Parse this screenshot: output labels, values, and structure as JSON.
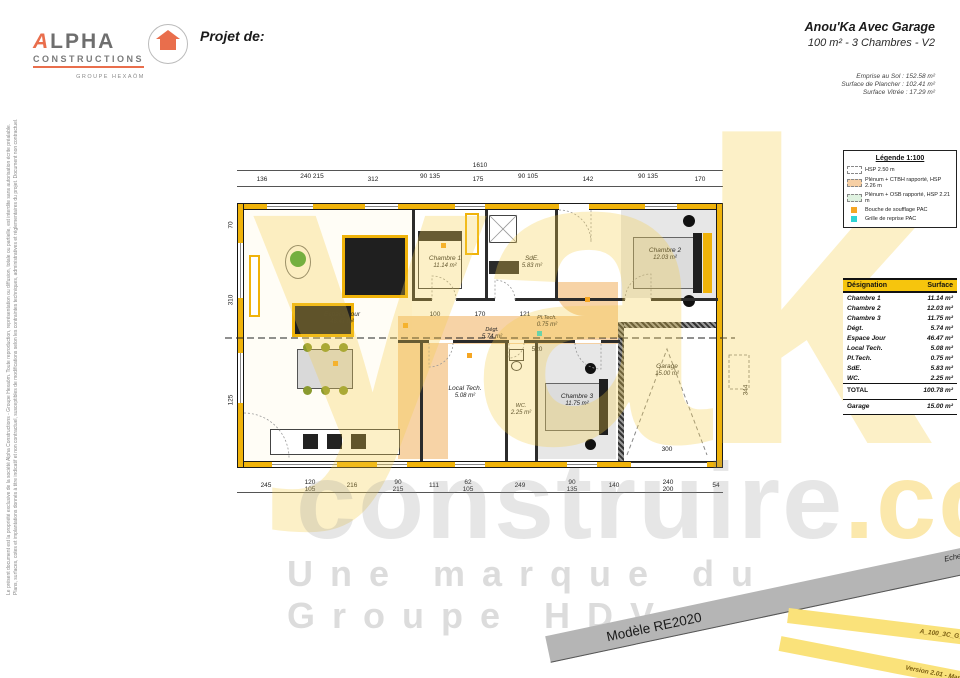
{
  "header": {
    "project_label": "Projet de:",
    "title": "Anou'Ka Avec Garage",
    "subtitle": "100 m² - 3 Chambres - V2",
    "surfaces": [
      "Emprise au Sol : 152.58 m²",
      "Surface de Plancher : 102.41 m²",
      "Surface Vitrée : 17.29 m²"
    ],
    "logo": {
      "name_a": "A",
      "name_rest": "LPHA",
      "subtitle": "CONSTRUCTIONS",
      "group": "GROUPE HEXAÖM"
    }
  },
  "disclaimer": {
    "line1": "Le présent document est la propriété exclusive de la société Alpha Constructions - Groupe Hexaöm. Toute reproduction, représentation ou diffusion, totale ou partielle, est interdite sans autorisation écrite préalable.",
    "line2": "Plans, surfaces, cotes et implantations donnés à titre indicatif et non contractuel, susceptibles de modifications selon les contraintes techniques, administratives et réglementaires du projet. Document non contractuel."
  },
  "watermark": {
    "big": "yak",
    "mid": "construire",
    "dotcom": ".com",
    "tagline": "Une marque du Groupe HDV"
  },
  "legend": {
    "title": "Légende 1:100",
    "items": [
      "HSP 2.50 m",
      "Plénum + CTBH rapporté, HSP 2.26 m",
      "Plénum + OSB rapporté, HSP 2.21 m",
      "Bouche de soufflage PAC",
      "Grille de reprise PAC"
    ]
  },
  "surface_table": {
    "headers": [
      "Désignation",
      "Surface"
    ],
    "rows": [
      {
        "name": "Chambre 1",
        "area": "11.14 m²"
      },
      {
        "name": "Chambre 2",
        "area": "12.03 m²"
      },
      {
        "name": "Chambre 3",
        "area": "11.75 m²"
      },
      {
        "name": "Dégt.",
        "area": "5.74 m²"
      },
      {
        "name": "Espace Jour",
        "area": "46.47 m²"
      },
      {
        "name": "Local Tech.",
        "area": "5.08 m²"
      },
      {
        "name": "Pl.Tech.",
        "area": "0.75 m²"
      },
      {
        "name": "SdE.",
        "area": "5.83 m²"
      },
      {
        "name": "WC.",
        "area": "2.25 m²"
      }
    ],
    "total": {
      "name": "TOTAL",
      "area": "100.78 m²"
    },
    "garage": {
      "name": "Garage",
      "area": "15.00 m²"
    }
  },
  "plan": {
    "rooms": {
      "espace_jour": {
        "name": "Espace Jour",
        "area": "46.47 m²"
      },
      "chambre1": {
        "name": "Chambre 1",
        "area": "11.14 m²"
      },
      "chambre2": {
        "name": "Chambre 2",
        "area": "12.03 m²"
      },
      "chambre3": {
        "name": "Chambre 3",
        "area": "11.75 m²"
      },
      "sde": {
        "name": "SdE.",
        "area": "5.83 m²"
      },
      "degt": {
        "name": "Dégt.",
        "area": "5.74 m²"
      },
      "local_tech": {
        "name": "Local Tech.",
        "area": "5.08 m²"
      },
      "pl_tech": {
        "name": "Pl.Tech.",
        "area": "0.75 m²"
      },
      "wc": {
        "name": "WC.",
        "area": "2.25 m²"
      },
      "garage": {
        "name": "Garage",
        "area": "15.00 m²"
      }
    },
    "dims": {
      "overall_top": "1610",
      "top": [
        "136",
        "240 215",
        "312",
        "90 135",
        "175",
        "90 105",
        "142",
        "90 135",
        "170"
      ],
      "bottom": [
        "245",
        "120 105",
        "216",
        "90 215",
        "111",
        "62 105",
        "249",
        "90 135",
        "140",
        "240 200",
        "54"
      ],
      "left": [
        "70",
        "310",
        "125"
      ],
      "right": "344",
      "hall": "520",
      "garage_door": "300",
      "inner": [
        "100",
        "170",
        "121"
      ]
    }
  },
  "banners": {
    "model": "Modèle RE2020",
    "scale": "Echelle : 1/75è",
    "code": "A_100_3C_G_V2",
    "version": "Version 2.01 - Mars 2023"
  },
  "colors": {
    "wall_yellow": "#f0b30a",
    "accent_yellow": "#f6c50d",
    "plenum_orange": "#f6cfa4",
    "plenum_green": "#dff2e0",
    "logo_orange": "#e96e4c",
    "band_gray": "#b5b5b5",
    "band_yellow": "#fae27a",
    "soufflage_orange": "#f5a623",
    "reprise_cyan": "#2fd4d4"
  }
}
